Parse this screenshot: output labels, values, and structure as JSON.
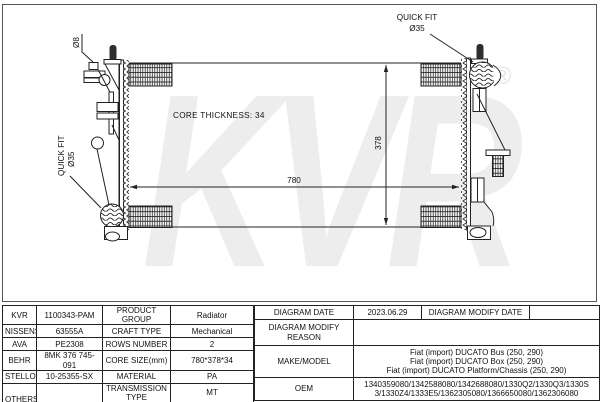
{
  "diagram": {
    "core_thickness_label": "CORE THICKNESS: 34",
    "width_dimension": "780",
    "height_dimension": "378",
    "bolt_diameter_label": "Ø8",
    "quick_fit_top": {
      "line1": "QUICK FIT",
      "line2": "Ø35"
    },
    "quick_fit_left": {
      "line1": "QUICK FIT",
      "line2": "Ø35"
    },
    "watermark_text": "KVR",
    "watermark_mark": "®"
  },
  "table": {
    "brands": [
      {
        "name": "KVR",
        "value": "1100343-PAM"
      },
      {
        "name": "NISSENS",
        "value": "63555A"
      },
      {
        "name": "AVA",
        "value": "PE2308"
      },
      {
        "name": "BEHR",
        "value": "8MK 376 745-091"
      },
      {
        "name": "STELLOX",
        "value": "10-25355-SX"
      },
      {
        "name": "OTHERS",
        "value": ""
      }
    ],
    "specs": [
      {
        "label": "PRODUCT GROUP",
        "value": "Radiator"
      },
      {
        "label": "CRAFT TYPE",
        "value": "Mechanical"
      },
      {
        "label": "ROWS NUMBER",
        "value": "2"
      },
      {
        "label": "CORE SIZE(mm)",
        "value": "780*378*34"
      },
      {
        "label": "MATERIAL",
        "value": "PA"
      },
      {
        "label": "TRANSMISSION TYPE",
        "value": "MT"
      },
      {
        "label": "SUPPLEMENTARY",
        "value": ""
      }
    ],
    "right": {
      "diagram_date_label": "DIAGRAM DATE",
      "diagram_date": "2023.06.29",
      "diagram_modify_date_label": "DIAGRAM MODIFY DATE",
      "diagram_modify_date": "",
      "diagram_modify_reason_label": "DIAGRAM MODIFY REASON",
      "diagram_modify_reason": "",
      "make_model_label": "MAKE/MODEL",
      "make_model_lines": [
        "Fiat (import) DUCATO Bus (250, 290)",
        "Fiat (import) DUCATO Box (250, 290)",
        "Fiat (import) DUCATO Platform/Chassis (250, 290)"
      ],
      "oem_label": "OEM",
      "oem_value": "1340359080/1342588080/1342688080/1330Q2/1330Q3/1330S3/1330Z4/1333E5/1362305080/1366650080/1362306080"
    }
  }
}
